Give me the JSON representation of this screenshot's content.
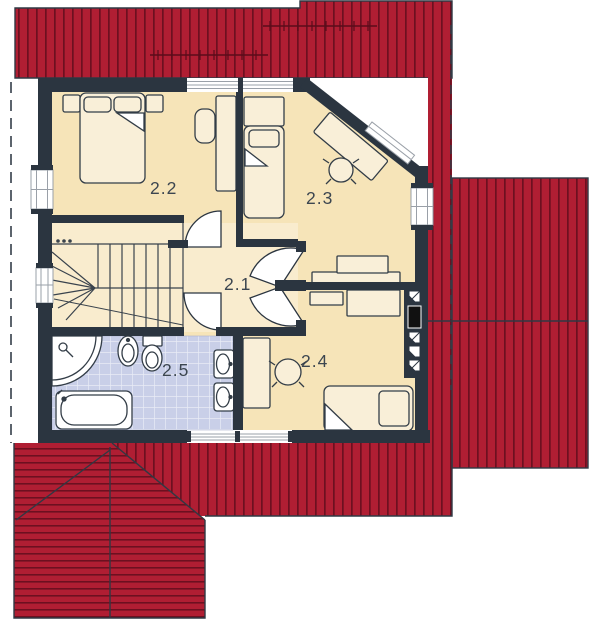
{
  "floor_plan": {
    "drawing_type": "attic-storey-floor-plan",
    "rooms": [
      {
        "label": "2.1",
        "name": "hallway-landing"
      },
      {
        "label": "2.2",
        "name": "bedroom-left"
      },
      {
        "label": "2.3",
        "name": "bedroom-right"
      },
      {
        "label": "2.4",
        "name": "bedroom-bottom"
      },
      {
        "label": "2.5",
        "name": "bathroom"
      }
    ],
    "colors": {
      "roof_red": "#b01e33",
      "roof_stripe": "#6d1020",
      "roof_seam": "#5a0c1a",
      "wall_dark": "#2b3540",
      "floor_cream": "#f6e4b8",
      "floor_hall": "#f9ecce",
      "bath_tile": "#c9cfe8",
      "tile_grid": "#e9ecf6",
      "furniture_fill": "#f9efd8",
      "outline": "#333d47",
      "label_text": "#3c4650"
    },
    "fixtures": [
      "staircase",
      "double-bed",
      "single-bed",
      "desk",
      "office-chair",
      "dresser",
      "corner-shower",
      "bathtub",
      "toilet",
      "bidet",
      "washbasin",
      "chimney-flues"
    ]
  }
}
